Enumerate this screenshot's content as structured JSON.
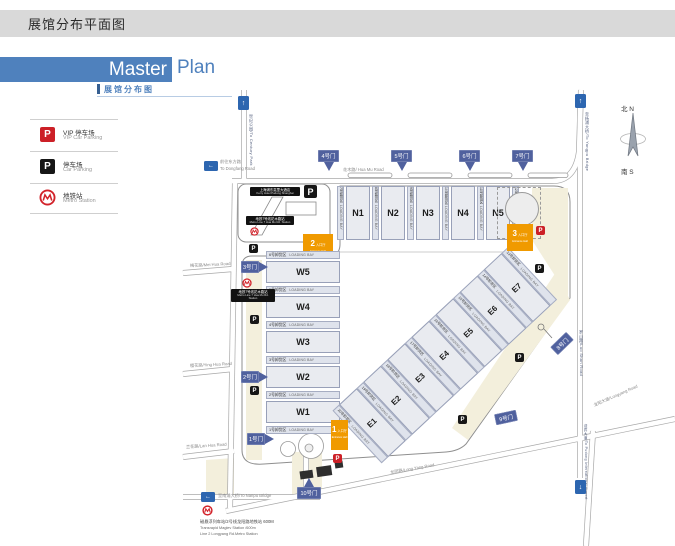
{
  "header": {
    "title": "展馆分布平面图"
  },
  "banner": {
    "master": "Master",
    "plan": "Plan",
    "subtitle": "展馆分布图"
  },
  "legend": {
    "p_letter": "P",
    "vip_zh": "VIP 停车场",
    "vip_en": "VIP Car Parking",
    "park_zh": "停车场",
    "park_en": "Car Parking",
    "metro_zh": "地铁站",
    "metro_en": "Metro Station"
  },
  "icons": {
    "up": "↑",
    "left": "←",
    "down": "↓"
  },
  "compass": {
    "n": "北 N",
    "s": "南 S"
  },
  "halls": {
    "w": [
      "W5",
      "W4",
      "W3",
      "W2",
      "W1"
    ],
    "n": [
      "N1",
      "N2",
      "N3",
      "N4",
      "N5"
    ],
    "e": [
      "E7",
      "E6",
      "E5",
      "E4",
      "E3",
      "E2",
      "E1"
    ]
  },
  "bays": {
    "loading": "LOADING BAY",
    "w": [
      "6号卸货区",
      "5号卸货区",
      "4号卸货区",
      "3号卸货区",
      "2号卸货区",
      "1号卸货区"
    ],
    "n": [
      "7号卸货区",
      "8号卸货区",
      "9号卸货区",
      "10号卸货区",
      "11号卸货区",
      "12号卸货区"
    ],
    "e": [
      "13号卸货区",
      "14号卸货区",
      "15号卸货区",
      "16号卸货区",
      "17号卸货区",
      "18号卸货区",
      "19号卸货区",
      "20号卸货区"
    ]
  },
  "entrances": {
    "zh": "入口厅",
    "en": "Entrance Hall",
    "nums": [
      "1",
      "2",
      "3"
    ]
  },
  "gates": [
    "1号门",
    "2号门",
    "3号门",
    "4号门",
    "5号门",
    "6号门",
    "7号门",
    "8号门",
    "9号门",
    "10号门"
  ],
  "roads": {
    "huamu": "花木路/ Hua Mu Road",
    "meihua": "梅花路/Mei Hua Road",
    "yinghua": "樱花路/Ying Hua Road",
    "lanhua": "兰花路/Lan Hua Road",
    "longyang": "龙阳路/Long Yang Road",
    "longyang_ave": "龙阳大道/Longyang Road",
    "luoshan": "罗山路/Luo Shan Road",
    "dongfang_zh": "前往东方路",
    "dongfang_en": "To Dongfang Road",
    "nanpu": "至南浦大桥/To Nanpu Bridge",
    "yangpu": "至杨浦大桥/To Yangpu Bridge",
    "century": "世纪公园/To Century Park",
    "airport": "迎宾大道/To Pudong International Airport"
  },
  "pois": {
    "kerry_zh": "上海浦东嘉里大酒店",
    "kerry_en": "Kerry Hotel Pudong Shanghai",
    "metro7_zh": "地铁7号线花木路站",
    "metro7_en": "Metro Line 7 Hua Mu Rd. Station",
    "maglev_zh": "磁悬浮列车站/2号线龙阳路地铁站  600M",
    "maglev_en1": "Transrapid Maglev Station /600m",
    "maglev_en2": "Line 2 Longyang Rd.Metro Station"
  },
  "colors": {
    "banner_blue": "#4f81bd",
    "gate_blue": "#50619e",
    "arrow_blue": "#2d66b0",
    "entrance_orange": "#f09a00",
    "vip_red": "#cc2027",
    "parking_black": "#161616",
    "beige": "#f3efdc",
    "header_gray": "#d9d9d9"
  }
}
